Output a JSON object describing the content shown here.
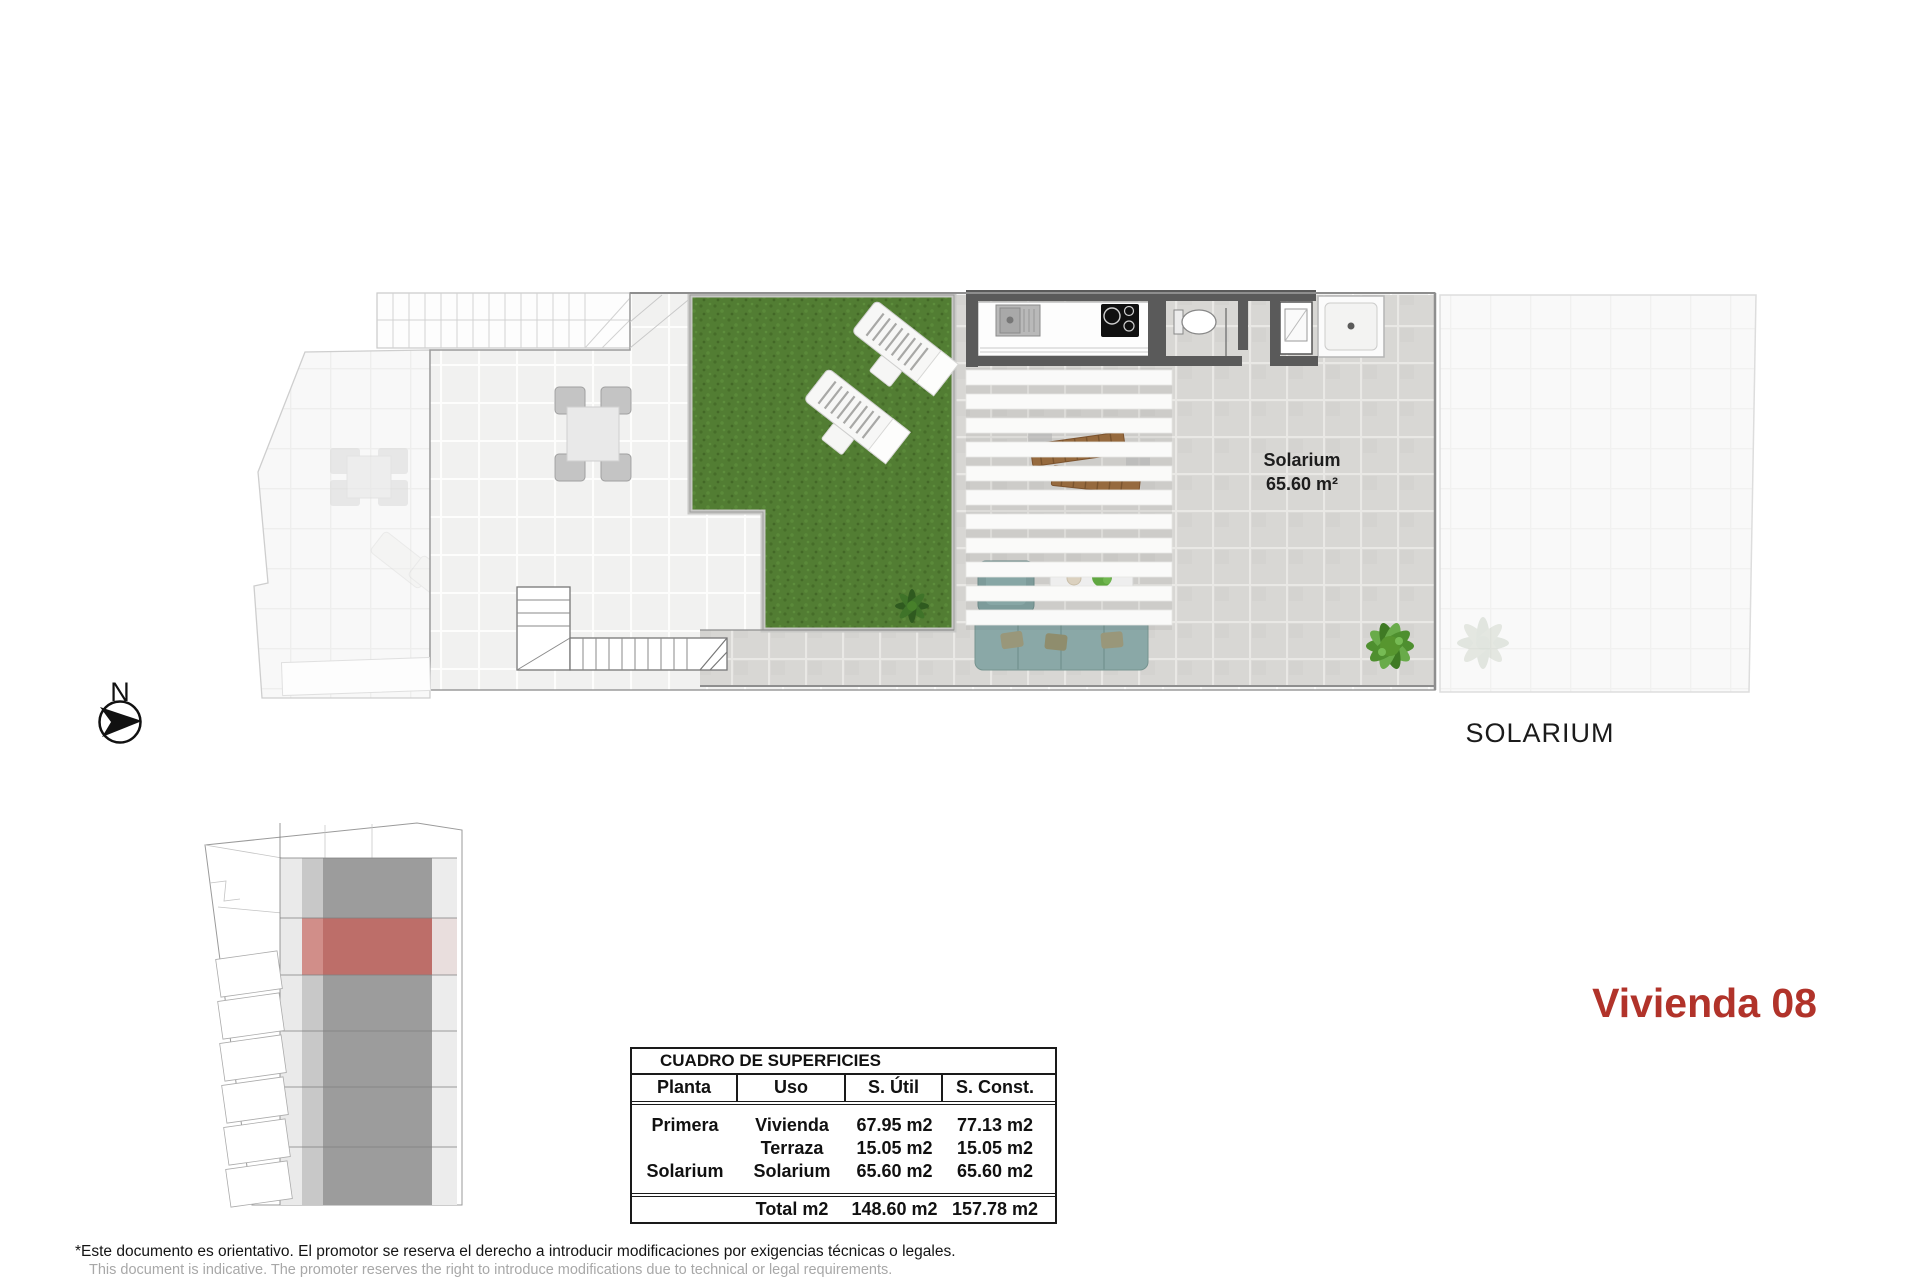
{
  "plan": {
    "room_label": {
      "name": "Solarium",
      "area": "65.60 m²"
    },
    "caption": "SOLARIUM"
  },
  "site_plan": {
    "north_label": "N"
  },
  "title": "Vivienda 08",
  "areas_table": {
    "title": "CUADRO DE SUPERFICIES",
    "columns": [
      "Planta",
      "Uso",
      "S. Útil",
      "S. Const."
    ],
    "rows": [
      {
        "planta": "Primera",
        "uso": "Vivienda",
        "util": "67.95 m2",
        "const": "77.13 m2"
      },
      {
        "planta": "",
        "uso": "Terraza",
        "util": "15.05 m2",
        "const": "15.05 m2"
      },
      {
        "planta": "Solarium",
        "uso": "Solarium",
        "util": "65.60 m2",
        "const": "65.60 m2"
      }
    ],
    "total": {
      "label": "Total m2",
      "util": "148.60 m2",
      "const": "157.78 m2"
    }
  },
  "disclaimer": {
    "es": "*Este documento es orientativo. El promotor se reserva el derecho a introducir modificaciones por exigencias técnicas o legales.",
    "en": "This document is indicative. The promoter reserves the right to introduce modifications due to technical or legal requirements."
  },
  "colors": {
    "accent_red": "#b1332a",
    "site_highlight": "#bd6e69",
    "grass_green": "#527d33"
  }
}
